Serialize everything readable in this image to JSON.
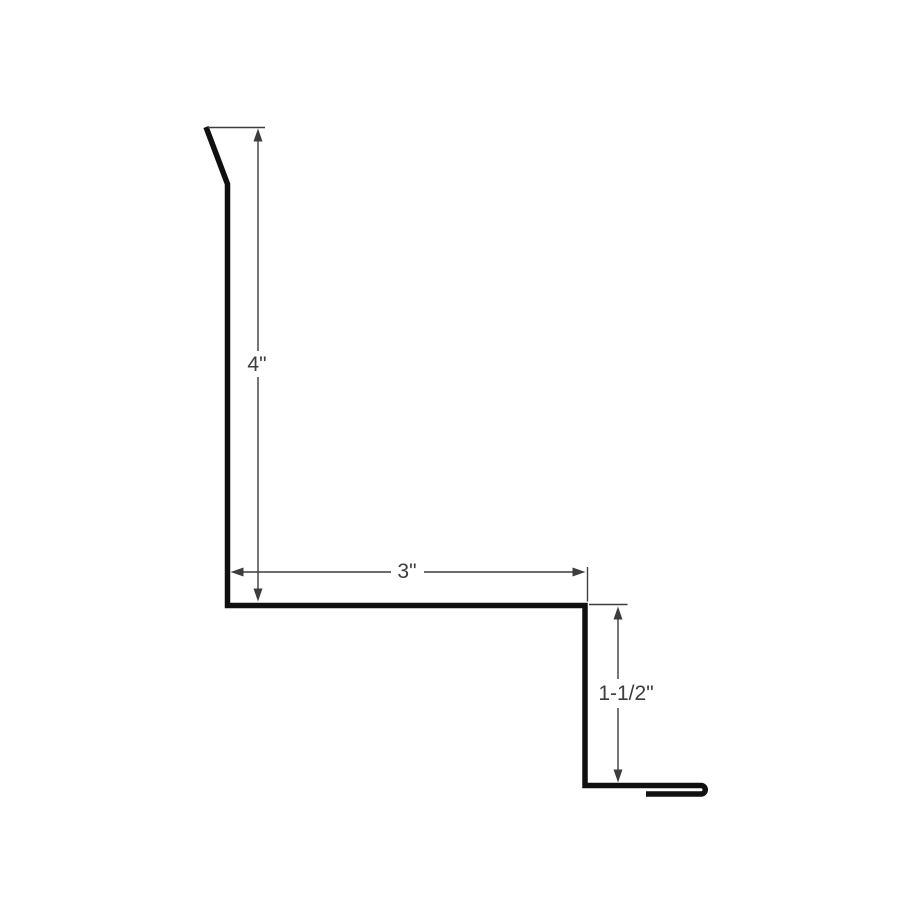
{
  "diagram": {
    "type": "technical-profile-drawing",
    "dimensions": {
      "face_height": {
        "label": "4\""
      },
      "top_run": {
        "label": "3\""
      },
      "drop_leg": {
        "label": "1-1/2\""
      }
    },
    "colors": {
      "background": "#ffffff",
      "profile_stroke": "#101010",
      "dimension_stroke": "#3d3d3d",
      "label_text": "#3d3d3d"
    }
  }
}
